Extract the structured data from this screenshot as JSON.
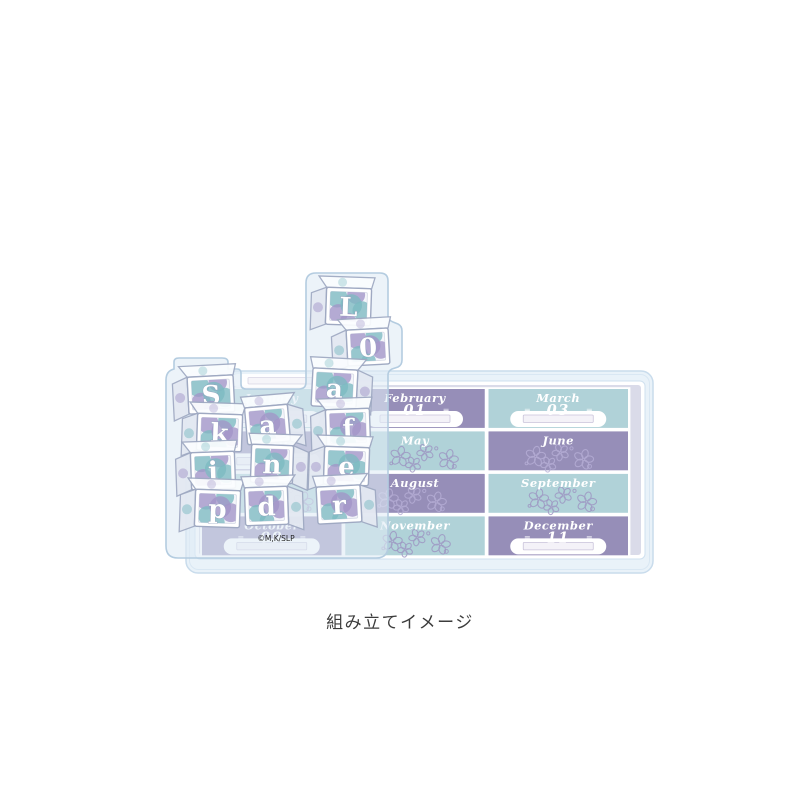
{
  "caption": "組み立てイメージ",
  "product": {
    "copyright": "©M,K/SLP",
    "calendar": {
      "months": [
        {
          "name": "January",
          "color": "teal",
          "type": "slot",
          "number": "",
          "marks": "none"
        },
        {
          "name": "February",
          "color": "purple",
          "type": "slot",
          "number": "01",
          "marks": "right"
        },
        {
          "name": "March",
          "color": "teal",
          "type": "slot",
          "number": "03",
          "marks": "both"
        },
        {
          "name": "April",
          "color": "purple",
          "type": "slot",
          "number": "",
          "marks": "none"
        },
        {
          "name": "May",
          "color": "teal",
          "type": "flowers"
        },
        {
          "name": "June",
          "color": "purple",
          "type": "flowers"
        },
        {
          "name": "July",
          "color": "teal",
          "type": "flowers"
        },
        {
          "name": "August",
          "color": "purple",
          "type": "flowers"
        },
        {
          "name": "September",
          "color": "teal",
          "type": "flowers"
        },
        {
          "name": "October",
          "color": "purple",
          "type": "slot",
          "number": "09",
          "marks": "both"
        },
        {
          "name": "November",
          "color": "teal",
          "type": "flowers"
        },
        {
          "name": "December",
          "color": "purple",
          "type": "slot",
          "number": "11",
          "marks": "both"
        }
      ]
    },
    "blocks": {
      "words": [
        "Skip",
        "and",
        "Loafer"
      ],
      "letters": [
        [
          "S",
          "k",
          "i",
          "p"
        ],
        [
          "a",
          "n",
          "d"
        ],
        [
          "L",
          "0",
          "a",
          "f",
          "e",
          "r"
        ]
      ]
    },
    "colors": {
      "purpleCell": "#968eb8",
      "tealCell": "#b0d2d8",
      "monthText": "#ffffff",
      "flowerOnTeal": "#9d94c2",
      "flowerOnPurple": "#b7afd7",
      "panelFill": "rgba(224,235,245,0.6)",
      "panelStroke": "#b4cce0",
      "baseFill": "#e9f2f9",
      "baseStroke": "#c9dcec",
      "boardStroke": "#cfe0ef",
      "marginFill": "#dadbe9",
      "dotTeal": "#7cbac2",
      "dotPurple": "#a195c8",
      "blockStroke": "#9fa9c2",
      "blockInner": "#edf0f7",
      "slotBorder": "#c9c3da",
      "slotFill": "#f4f2f8",
      "copyrightColor": "#222222"
    }
  }
}
